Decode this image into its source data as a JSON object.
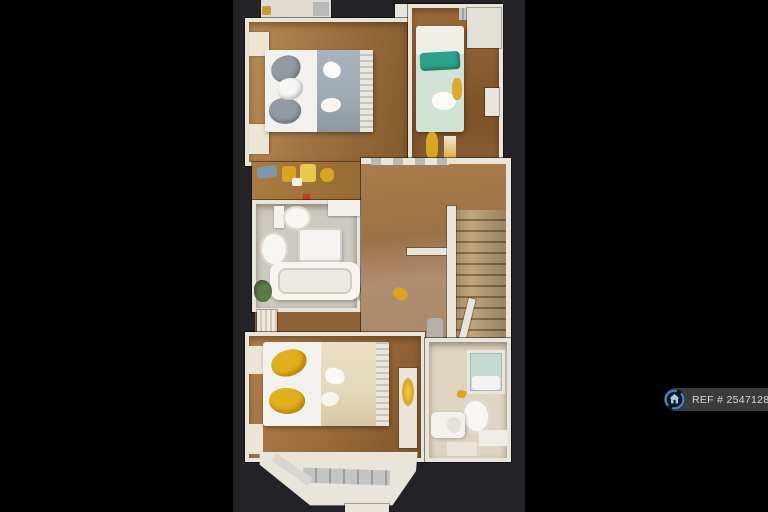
{
  "watermark": {
    "ref_text": "REF # 2547128",
    "icon": "house-in-circle-badge-icon"
  },
  "scene": {
    "type": "3d-dollhouse-floorplan-top-view",
    "orientation": "portrait-photo-on-black-canvas",
    "rooms": [
      {
        "name": "bedroom-front",
        "position": "top-left",
        "floor": "wood",
        "furniture": [
          "double-bed-white-gray",
          "gray-pillows",
          "ribbed-headboard",
          "wardrobes-top",
          "two-window-sills-left"
        ]
      },
      {
        "name": "bedroom-single",
        "position": "top-right",
        "floor": "wood",
        "furniture": [
          "single-bed-mint",
          "teal-cushion",
          "white-wardrobe",
          "bedside-cabinet",
          "silver-radiator",
          "gold-clothes"
        ]
      },
      {
        "name": "bathroom",
        "position": "middle-left",
        "floor": "tile-gray",
        "furniture": [
          "vanity-shelf-gold-items",
          "blue-towel",
          "red-bottle",
          "toilet",
          "pedestal-basin",
          "shower-unit",
          "bathtub",
          "plant"
        ]
      },
      {
        "name": "landing",
        "position": "middle-right",
        "floor": "wood-and-carpet",
        "furniture": [
          "staircase-down",
          "white-banister",
          "open-door",
          "gray-radiator",
          "yellow-object-on-floor"
        ]
      },
      {
        "name": "bedroom-rear",
        "position": "bottom-left",
        "floor": "wood",
        "furniture": [
          "double-bed-gold-pillows",
          "ribbed-footboard",
          "bay-window",
          "radiator-with-gold-lamp",
          "window-sills-left"
        ]
      },
      {
        "name": "shower-room",
        "position": "bottom-right",
        "floor": "vinyl-cream",
        "furniture": [
          "corner-shower",
          "toilet",
          "vanity-basin",
          "window-sills",
          "gold-object"
        ]
      }
    ]
  },
  "theme": {
    "canvas_bg": "#000000",
    "photo_bg": "#232327",
    "wall": "#e9e5db",
    "wall_shade": "#c8c2b4",
    "wood_a": "#a1713f",
    "wood_b": "#b5854f",
    "wood_dark": "#7c5228",
    "hall_carpet": "#b08e72",
    "bath_floor": "#cdc9c1",
    "ensuite_floor": "#ded4c1",
    "stair_carpet": "#c0a67d",
    "stair_tread": "#8f6c45",
    "duvet_white": "#f2f1ed",
    "blanket_gray": "#a0a9b3",
    "pillow_gray": "#939aa3",
    "blanket_cream": "#e5d9bc",
    "pillow_gold": "#e2b01d",
    "duvet_mint": "#cfe2d4",
    "cushion_teal": "#2aa188",
    "shower_glass": "#c5dad3",
    "plant": "#587a46",
    "gold": "#d9a41f",
    "badge_bg": "#3b3b3d",
    "badge_text": "#d9d9d9",
    "badge_ring": "#3f86c9",
    "badge_house": "#aacbe9",
    "badge_icon_bg": "#0d1520"
  }
}
